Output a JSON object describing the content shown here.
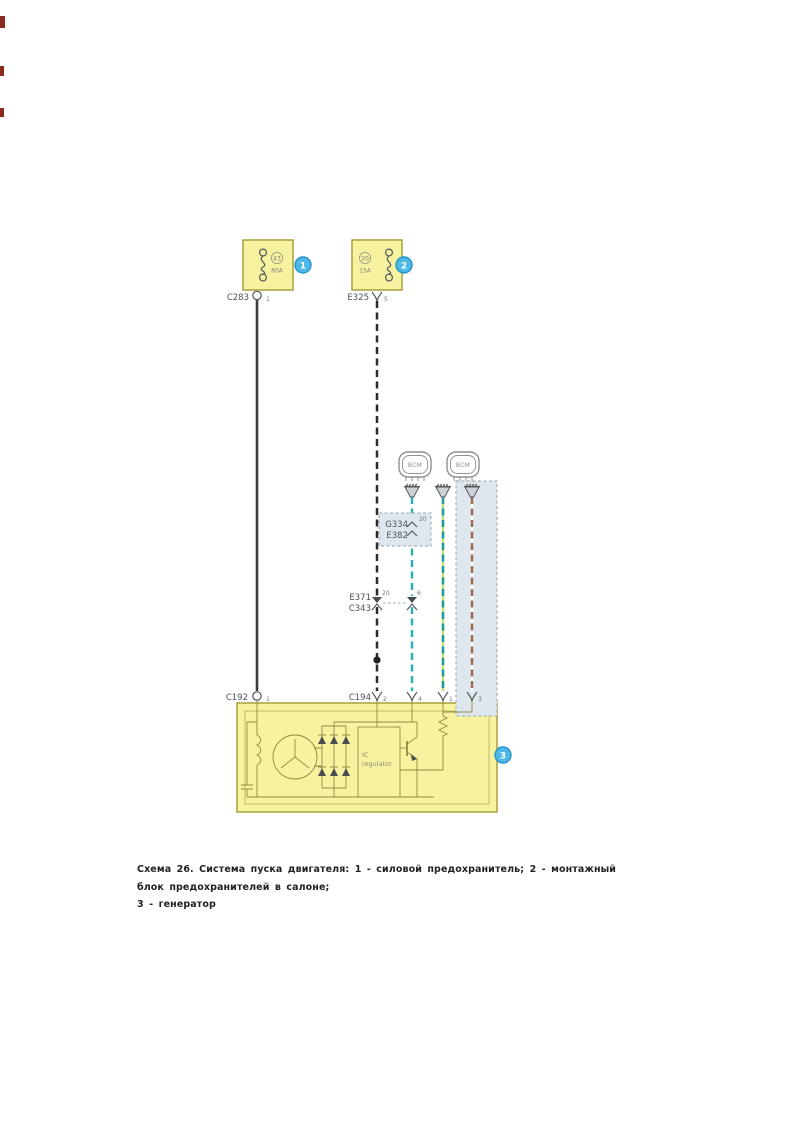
{
  "caption": {
    "line1": "Схема 26. Система пуска двигателя: 1 - силовой предохранитель; 2 - монтажный блок предохранителей в салоне;",
    "line2": "3 - генератор"
  },
  "diagram": {
    "colors": {
      "box_fill": "#f7f2a0",
      "box_border": "#a89f3c",
      "regulator_fill": "#fbf7d6",
      "gray_fill": "#dfe7ee",
      "gray_border": "#9aa3ab",
      "callout_fill": "#4db7e6",
      "callout_border": "#2695cb",
      "wire_power": "#3b3f3c",
      "wire_black": "#2b2b2b",
      "wire_teal": "#2ab1b5",
      "wire_teal_dark": "#1d9b9e",
      "wire_green_base": "#c6dd72",
      "wire_brown": "#9a6a4e",
      "wire_white_base": "#ffffff",
      "splice": "#222222"
    },
    "fuse1": {
      "number": "43",
      "rating": "80A",
      "connector": "C283",
      "pin": "1",
      "callout": "1"
    },
    "fuse2": {
      "number": "20",
      "rating": "15A",
      "connector": "E325",
      "pin": "5",
      "callout": "2"
    },
    "modules": {
      "bcm1": "BCM",
      "bcm2": "BCM"
    },
    "inline_connector": {
      "label_top": "G334",
      "label_bottom": "E382",
      "pin": "20"
    },
    "pair_connector": {
      "label_top": "E371",
      "label_bottom": "C343",
      "pin_left": "20",
      "pin_right": "6"
    },
    "gen_connector1": {
      "label": "C192",
      "pin": "1"
    },
    "gen_connector2": {
      "label": "C194",
      "p1": "2",
      "p2": "4",
      "p3": "1",
      "p4": "3"
    },
    "generator": {
      "regulator_line1": "IC",
      "regulator_line2": "regulator",
      "callout": "3"
    }
  }
}
